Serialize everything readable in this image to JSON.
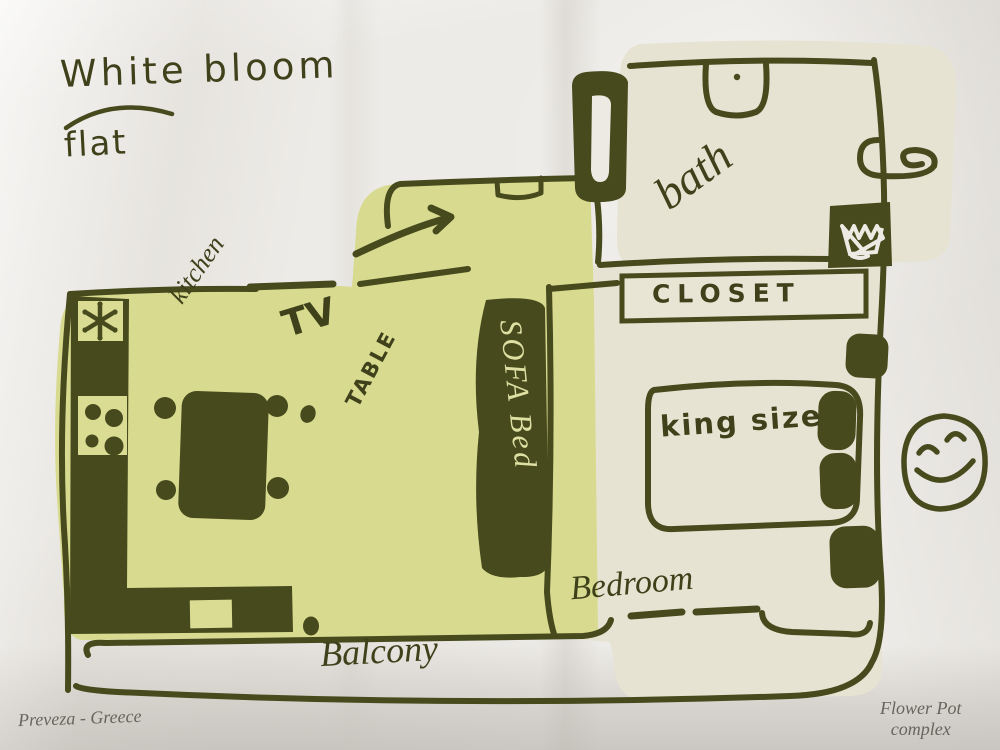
{
  "palette": {
    "ink": "#474a1d",
    "living_area_fill": "#d8db8f",
    "bed_bath_fill": "#e7e3d2",
    "paper": "#edebe7",
    "sofa_text": "#dde0a2",
    "footer_text": "#67665c"
  },
  "title": {
    "line1": "White bloom",
    "line2": "flat"
  },
  "rooms": {
    "bath": "bath",
    "closet": "CLOSET",
    "kitchen": "kitchen",
    "bedroom": "Bedroom",
    "balcony": "Balcony"
  },
  "furniture": {
    "tv": "TV",
    "table": "TABLE",
    "sofa_bed": "SOFA Bed",
    "king_bed": "king size"
  },
  "footer": {
    "location": "Preveza - Greece",
    "complex_line1": "Flower Pot",
    "complex_line2": "complex"
  },
  "icons": {
    "toilet": "toilet-icon",
    "sink": "sink-icon",
    "washing_machine": "washing-machine-icon",
    "stove_burners": "stove-burners-icon",
    "vent": "asterisk-vent-icon",
    "smiley": "smiley-face-icon",
    "entry_arrow": "entry-arrow-icon",
    "entry_door": "entry-door-icon"
  }
}
